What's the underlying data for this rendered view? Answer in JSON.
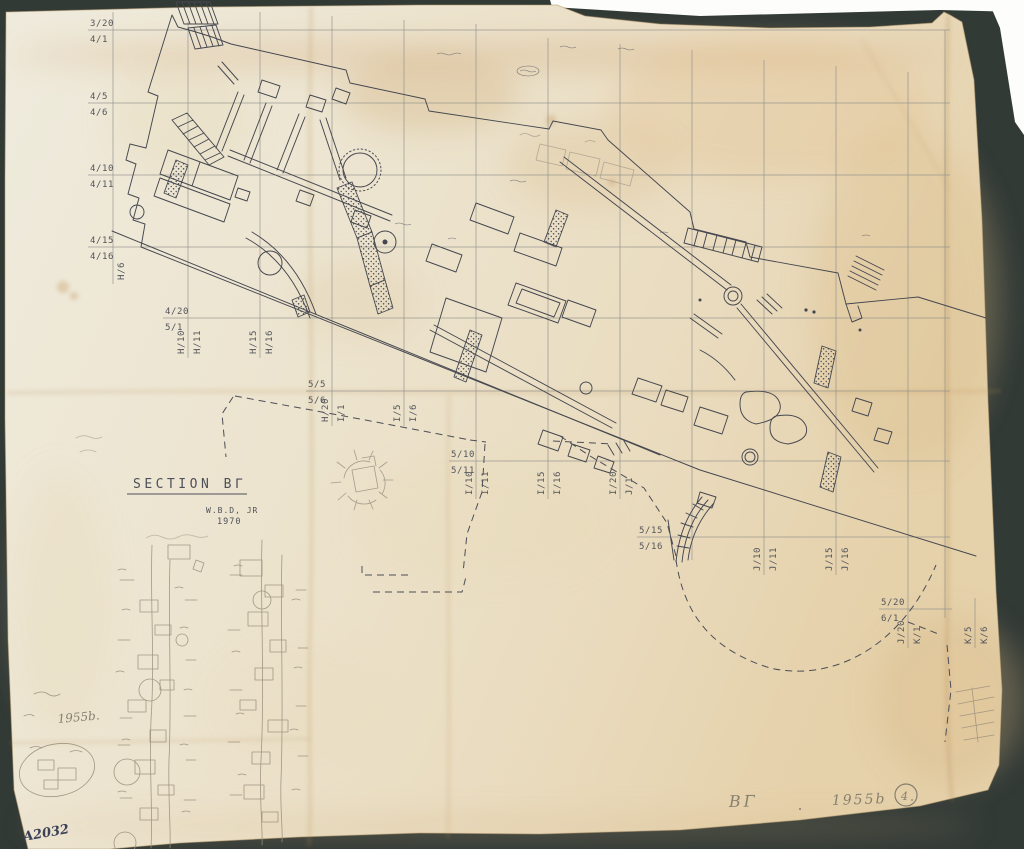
{
  "colors": {
    "mat_background": "#353c39",
    "paper": "#ece3cd",
    "ink": "#45474f",
    "pencil": "#998f7d",
    "handwriting_ink": "#3c4157"
  },
  "title_block": {
    "section_label": "SECTION BΓ",
    "surveyor": "W.B.D, JR",
    "year": "1970"
  },
  "annotations": {
    "sketch_year_label": "1955b.",
    "archive_number": "A2032",
    "footer_section": "BΓ",
    "footer_year": "1955b",
    "footer_circled_number": "4"
  },
  "grid": {
    "row_labels": [
      {
        "above": "3/20",
        "below": "4/1"
      },
      {
        "above": "4/5",
        "below": "4/6"
      },
      {
        "above": "4/10",
        "below": "4/11"
      },
      {
        "above": "4/15",
        "below": "4/16"
      },
      {
        "above": "4/20",
        "below": "5/1"
      },
      {
        "above": "5/5",
        "below": "5/6"
      },
      {
        "above": "5/10",
        "below": "5/11"
      },
      {
        "above": "5/15",
        "below": "5/16"
      },
      {
        "above": "5/20",
        "below": "6/1"
      }
    ],
    "column_labels": [
      {
        "left": "H/6",
        "right": ""
      },
      {
        "left": "H/10",
        "right": "H/11"
      },
      {
        "left": "H/15",
        "right": "H/16"
      },
      {
        "left": "H/20",
        "right": "I/1"
      },
      {
        "left": "I/5",
        "right": "I/6"
      },
      {
        "left": "I/10",
        "right": "I/11"
      },
      {
        "left": "I/15",
        "right": "I/16"
      },
      {
        "left": "I/20",
        "right": "J/1"
      },
      {
        "left": "J/10",
        "right": "J/11"
      },
      {
        "left": "J/15",
        "right": "J/16"
      },
      {
        "left": "J/20",
        "right": "K/1"
      },
      {
        "left": "K/5",
        "right": "K/6"
      }
    ]
  }
}
